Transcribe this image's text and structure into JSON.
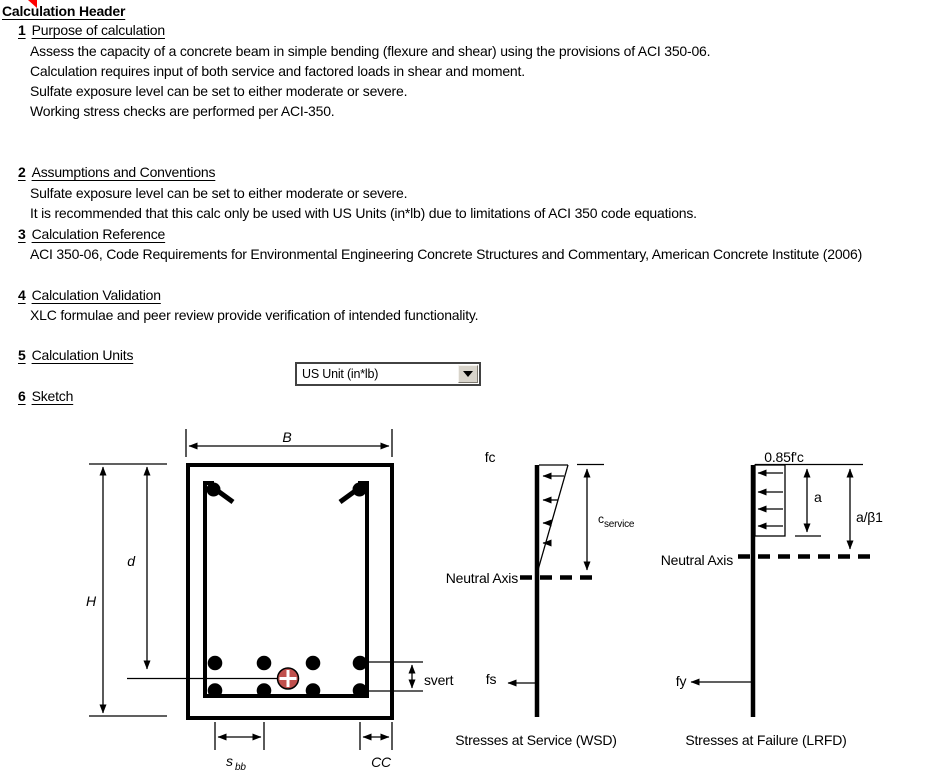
{
  "header": {
    "title": "Calculation Header"
  },
  "sections": [
    {
      "num": "1",
      "title": "Purpose of calculation",
      "lines": [
        "Assess the capacity of a concrete beam in simple bending (flexure and shear) using the provisions of ACI 350-06.",
        "Calculation requires input of both service and factored loads in shear and moment.",
        "Sulfate exposure level can be set to either moderate or severe.",
        "Working stress checks are performed per ACI-350."
      ]
    },
    {
      "num": "2",
      "title": "Assumptions and Conventions",
      "lines": [
        "Sulfate exposure level can be set to either moderate or severe.",
        "It is recommended that this calc only be used with US Units (in*lb) due to limitations of ACI 350 code equations."
      ]
    },
    {
      "num": "3",
      "title": "Calculation Reference",
      "lines": [
        "ACI 350-06, Code Requirements for Environmental Engineering Concrete Structures and Commentary, American Concrete Institute (2006)"
      ]
    },
    {
      "num": "4",
      "title": "Calculation Validation",
      "lines": [
        "XLC formulae and peer review provide verification of intended functionality."
      ]
    },
    {
      "num": "5",
      "title": "Calculation Units",
      "lines": []
    },
    {
      "num": "6",
      "title": "Sketch",
      "lines": []
    }
  ],
  "units_dropdown": {
    "value": "US Unit (in*lb)"
  },
  "icons": {
    "units_dropdown_arrow": "chevron-down"
  },
  "sketch": {
    "beam": {
      "b": "B",
      "h": "H",
      "d": "d",
      "svert": "svert",
      "s_base": "s",
      "s_sub": "bb",
      "cc": "CC"
    },
    "service": {
      "fc": "fc",
      "fs": "fs",
      "c_base": "c",
      "c_sub": "service",
      "neutral_axis": "Neutral Axis",
      "caption": "Stresses at Service (WSD)"
    },
    "failure": {
      "stress": "0.85f'c",
      "a": "a",
      "a_beta": "a/β1",
      "fy": "fy",
      "neutral_axis": "Neutral Axis",
      "caption": "Stresses at Failure (LRFD)"
    },
    "colors": {
      "centroid_marker": "#C0504D",
      "centroid_ring": "#9E3E3B"
    }
  }
}
